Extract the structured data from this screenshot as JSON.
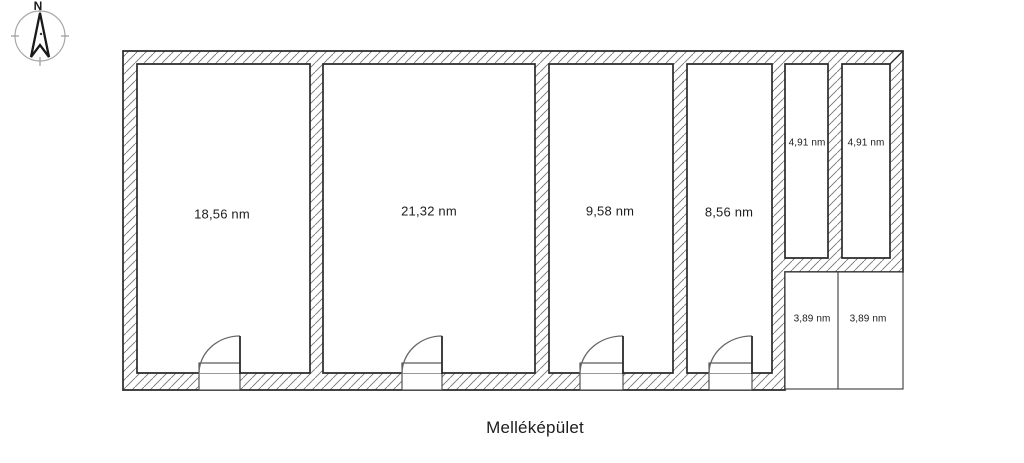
{
  "window": {
    "background": "#ffffff"
  },
  "compass": {
    "north_label": "N"
  },
  "plan": {
    "title": "Melléképület",
    "rooms": [
      {
        "area_label": "18,56 nm"
      },
      {
        "area_label": "21,32 nm"
      },
      {
        "area_label": "9,58 nm"
      },
      {
        "area_label": "8,56 nm"
      },
      {
        "area_label": "4,91 nm"
      },
      {
        "area_label": "4,91 nm"
      },
      {
        "area_label": "3,89 nm"
      },
      {
        "area_label": "3,89 nm"
      }
    ]
  },
  "colors": {
    "wall_outline": "#2a2a2a",
    "hatch_line": "#757575",
    "thin_line": "#3a3a3a",
    "text": "#1d1d1d",
    "background": "#ffffff"
  }
}
